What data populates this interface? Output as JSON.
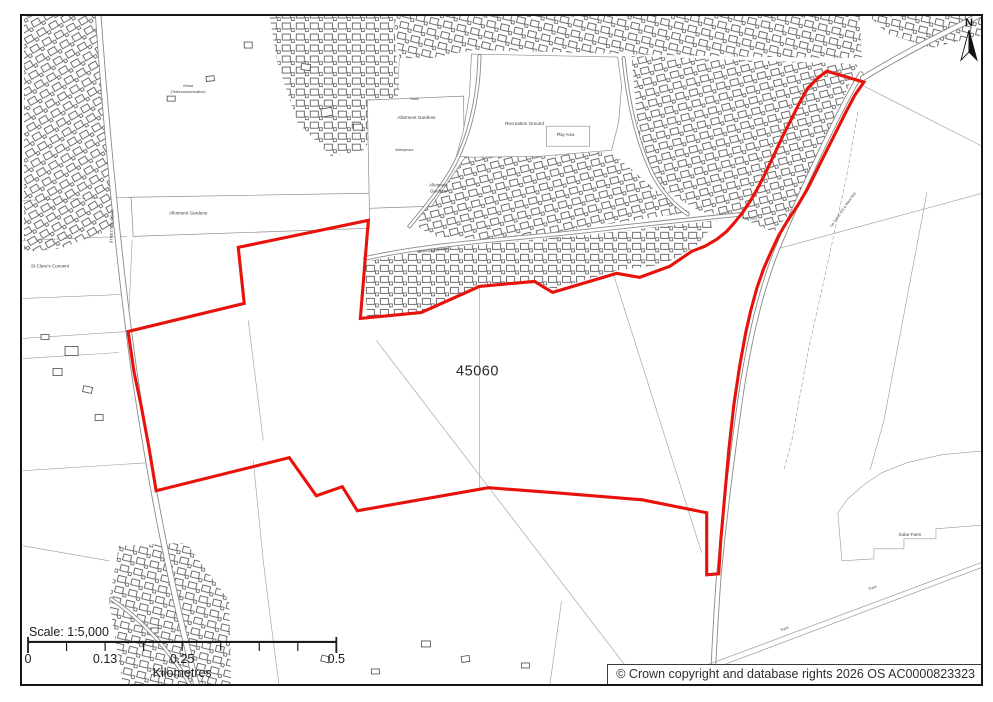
{
  "site": {
    "ref": "45060",
    "boundary_color": "#e8120c",
    "boundary_points": "825,71 862,82 853,95 844,112 835,130 826,148 816,168 806,188 796,205 786,220 777,235 769,252 762,268 755,288 749,310 744,332 738,365 732,405 727,450 723,495 719,540 717,573 705,574 705,512 640,499 553,492 487,487 356,510 341,486 315,495 288,457 155,490 148,448 140,405 133,372 127,331 243,303 237,247 367,220 359,318 420,312 478,286 533,281 551,292 615,273 638,277 668,266 690,251 703,246 715,239 725,231 733,222 741,212 749,200 757,186 765,170 773,153 781,136 789,120 797,104 806,88 816,78"
  },
  "scale_bar": {
    "title": "Scale: 1:5,000",
    "unit": "Kilometres",
    "ticks": [
      {
        "label": "0",
        "x": 27
      },
      {
        "label": "0.13",
        "x": 104
      },
      {
        "label": "0.25",
        "x": 181
      },
      {
        "label": "0.5",
        "x": 335
      }
    ],
    "geometry": {
      "x0": 27,
      "x1": 335,
      "y": 641,
      "tick_xs": [
        27,
        65.5,
        104,
        142.5,
        181,
        219.5,
        258,
        296.5,
        335
      ]
    }
  },
  "copyright_text": "© Crown copyright and database rights 2026 OS AC0000823323",
  "north_arrow": {
    "label": "N"
  },
  "colors": {
    "boundary": "#e8120c",
    "frame": "#151515",
    "field_line": "#9a9a9a",
    "building": "#4a4a4a"
  },
  "map_labels": [
    {
      "text": "Allotment Gardens",
      "x": 415,
      "y": 119,
      "size": 4.6
    },
    {
      "text": "Allotment Gardens",
      "x": 187,
      "y": 214,
      "size": 4.6
    },
    {
      "text": "Allotment",
      "x": 437,
      "y": 186,
      "size": 4.4
    },
    {
      "text": "Gardens",
      "x": 437,
      "y": 192,
      "size": 4.4
    },
    {
      "text": "Recreation Ground",
      "x": 523,
      "y": 125,
      "size": 4.6
    },
    {
      "text": "Play Area",
      "x": 564,
      "y": 136,
      "size": 4.2
    },
    {
      "text": "St Clare's Convent",
      "x": 49,
      "y": 267,
      "size": 4.6
    },
    {
      "text": "Solar Farm",
      "x": 908,
      "y": 535,
      "size": 4.6
    },
    {
      "text": "Mead",
      "x": 187,
      "y": 87,
      "size": 3.8
    },
    {
      "text": "(Telecommunication)",
      "x": 187,
      "y": 93,
      "size": 3.8
    },
    {
      "text": "STRETTON ROAD",
      "x": 112,
      "y": 226,
      "size": 4.0,
      "rotate": -88
    },
    {
      "text": "Co Const, ED & Ward Bdy",
      "x": 842,
      "y": 210,
      "size": 3.6,
      "rotate": -55
    },
    {
      "text": "Track",
      "x": 413,
      "y": 100,
      "size": 3.6
    },
    {
      "text": "Track",
      "x": 783,
      "y": 629,
      "size": 3.6,
      "rotate": -20
    },
    {
      "text": "Track",
      "x": 871,
      "y": 588,
      "size": 3.6,
      "rotate": -20
    },
    {
      "text": "Path (um)",
      "x": 748,
      "y": 219,
      "size": 3.4
    },
    {
      "text": "SPRINGVALE ROAD",
      "x": 433,
      "y": 251,
      "size": 3.4,
      "rotate": -6
    },
    {
      "text": "Abbeymore",
      "x": 403,
      "y": 151,
      "size": 3.6
    }
  ],
  "map_geometry": {
    "field_lines": [
      "M22,200 L130,197",
      "M22,240 L126,236",
      "M22,298 L122,294",
      "M22,358 L118,352",
      "M127,331 L22,338",
      "M131,240 L127,330",
      "M247,320 L262,440",
      "M478,288 L478,487",
      "M375,340 L640,686",
      "M610,268 L700,552",
      "M770,250 L984,192",
      "M862,86 L984,148",
      "M925,192 L905,298 L882,420 L868,470",
      "M22,470 L148,462",
      "M22,545 L108,560",
      "M252,460 L262,560 L272,640 L278,686",
      "M560,600 L548,686",
      "M836,512 L846,498 L862,484 L880,472 L905,462 L940,454 L984,450",
      "M836,512 L840,560",
      "M840,560 L872,558 L872,548 L902,548 L902,538 L934,538 L934,528 L984,524",
      "M367,100 L463,96",
      "M367,103 L463,99",
      "M398,58 L396,96",
      "M717,577 L713,686"
    ],
    "ward_lines": [
      "M856,112 L844,180 L826,262 L806,352 L790,440 L782,470"
    ],
    "parcels": [
      "130,197 368,193 368,228 132,236",
      "366,100 462,96 463,158 430,206 368,208",
      "470,54 616,57 620,86 617,122 610,150 540,156 470,157 455,156 462,130 468,95",
      "545,126 588,126 588,146 545,146"
    ],
    "zones": [
      {
        "points": "23,16 97,16 112,228 60,248 23,252",
        "p": 3
      },
      {
        "points": "118,545 185,542 228,600 230,686 122,686 108,600",
        "p": 1
      },
      {
        "points": "268,15 392,15 398,92 362,150 330,156 296,122 276,62",
        "p": 0
      },
      {
        "points": "392,15 858,15 860,58 700,56 628,54 472,50 430,58 398,58",
        "p": 1
      },
      {
        "points": "630,56 856,64 798,200 772,232 736,216 700,212 656,186 636,130",
        "p": 2
      },
      {
        "points": "362,262 420,250 500,242 590,234 660,226 716,220 694,246 662,264 616,270 552,289 533,280 478,285 420,311 366,317",
        "p": 0
      },
      {
        "points": "436,156 610,152 654,190 688,212 618,222 500,240 432,236 416,226 428,186",
        "p": 2
      },
      {
        "points": "866,15 984,15 984,34 930,48 886,34",
        "p": 1
      }
    ],
    "buildings": [
      [
        320,
        108,
        11,
        8,
        -10
      ],
      [
        352,
        124,
        9,
        6,
        0
      ],
      [
        300,
        64,
        9,
        6,
        8
      ],
      [
        243,
        42,
        8,
        6,
        0
      ],
      [
        205,
        76,
        8,
        5,
        -6
      ],
      [
        166,
        96,
        8,
        5,
        0
      ],
      [
        64,
        346,
        13,
        9,
        0
      ],
      [
        52,
        368,
        9,
        7,
        0
      ],
      [
        82,
        386,
        9,
        6,
        12
      ],
      [
        40,
        334,
        8,
        5,
        0
      ],
      [
        94,
        414,
        8,
        6,
        0
      ],
      [
        150,
        627,
        7,
        5,
        0
      ],
      [
        420,
        640,
        9,
        6,
        0
      ],
      [
        460,
        655,
        8,
        6,
        -8
      ],
      [
        520,
        662,
        8,
        5,
        0
      ],
      [
        320,
        655,
        8,
        6,
        15
      ],
      [
        370,
        668,
        8,
        5,
        0
      ]
    ],
    "roads": [
      {
        "d": "M97,14 C104,110 116,250 134,378 C148,470 166,572 196,686",
        "w": 6.5
      },
      {
        "d": "M859,74 C836,112 798,194 774,252 C757,296 746,346 738,402 C731,452 722,522 717,576 C714,618 712,652 711,686",
        "w": 5.5
      },
      {
        "d": "M861,78 C900,54 948,30 984,12",
        "w": 6
      },
      {
        "d": "M364,258 C430,243 520,238 582,231 C642,224 690,219 740,214",
        "w": 4.5
      },
      {
        "d": "M478,56 C477,95 470,128 456,158 C446,180 428,202 408,226",
        "w": 4
      },
      {
        "d": "M622,58 C626,100 634,138 650,172 C660,192 672,204 686,214",
        "w": 4
      },
      {
        "d": "M110,598 C140,618 170,650 190,686",
        "w": 4
      }
    ],
    "tracks": [
      "M700,666 L984,560",
      "M703,671 L984,565"
    ]
  }
}
